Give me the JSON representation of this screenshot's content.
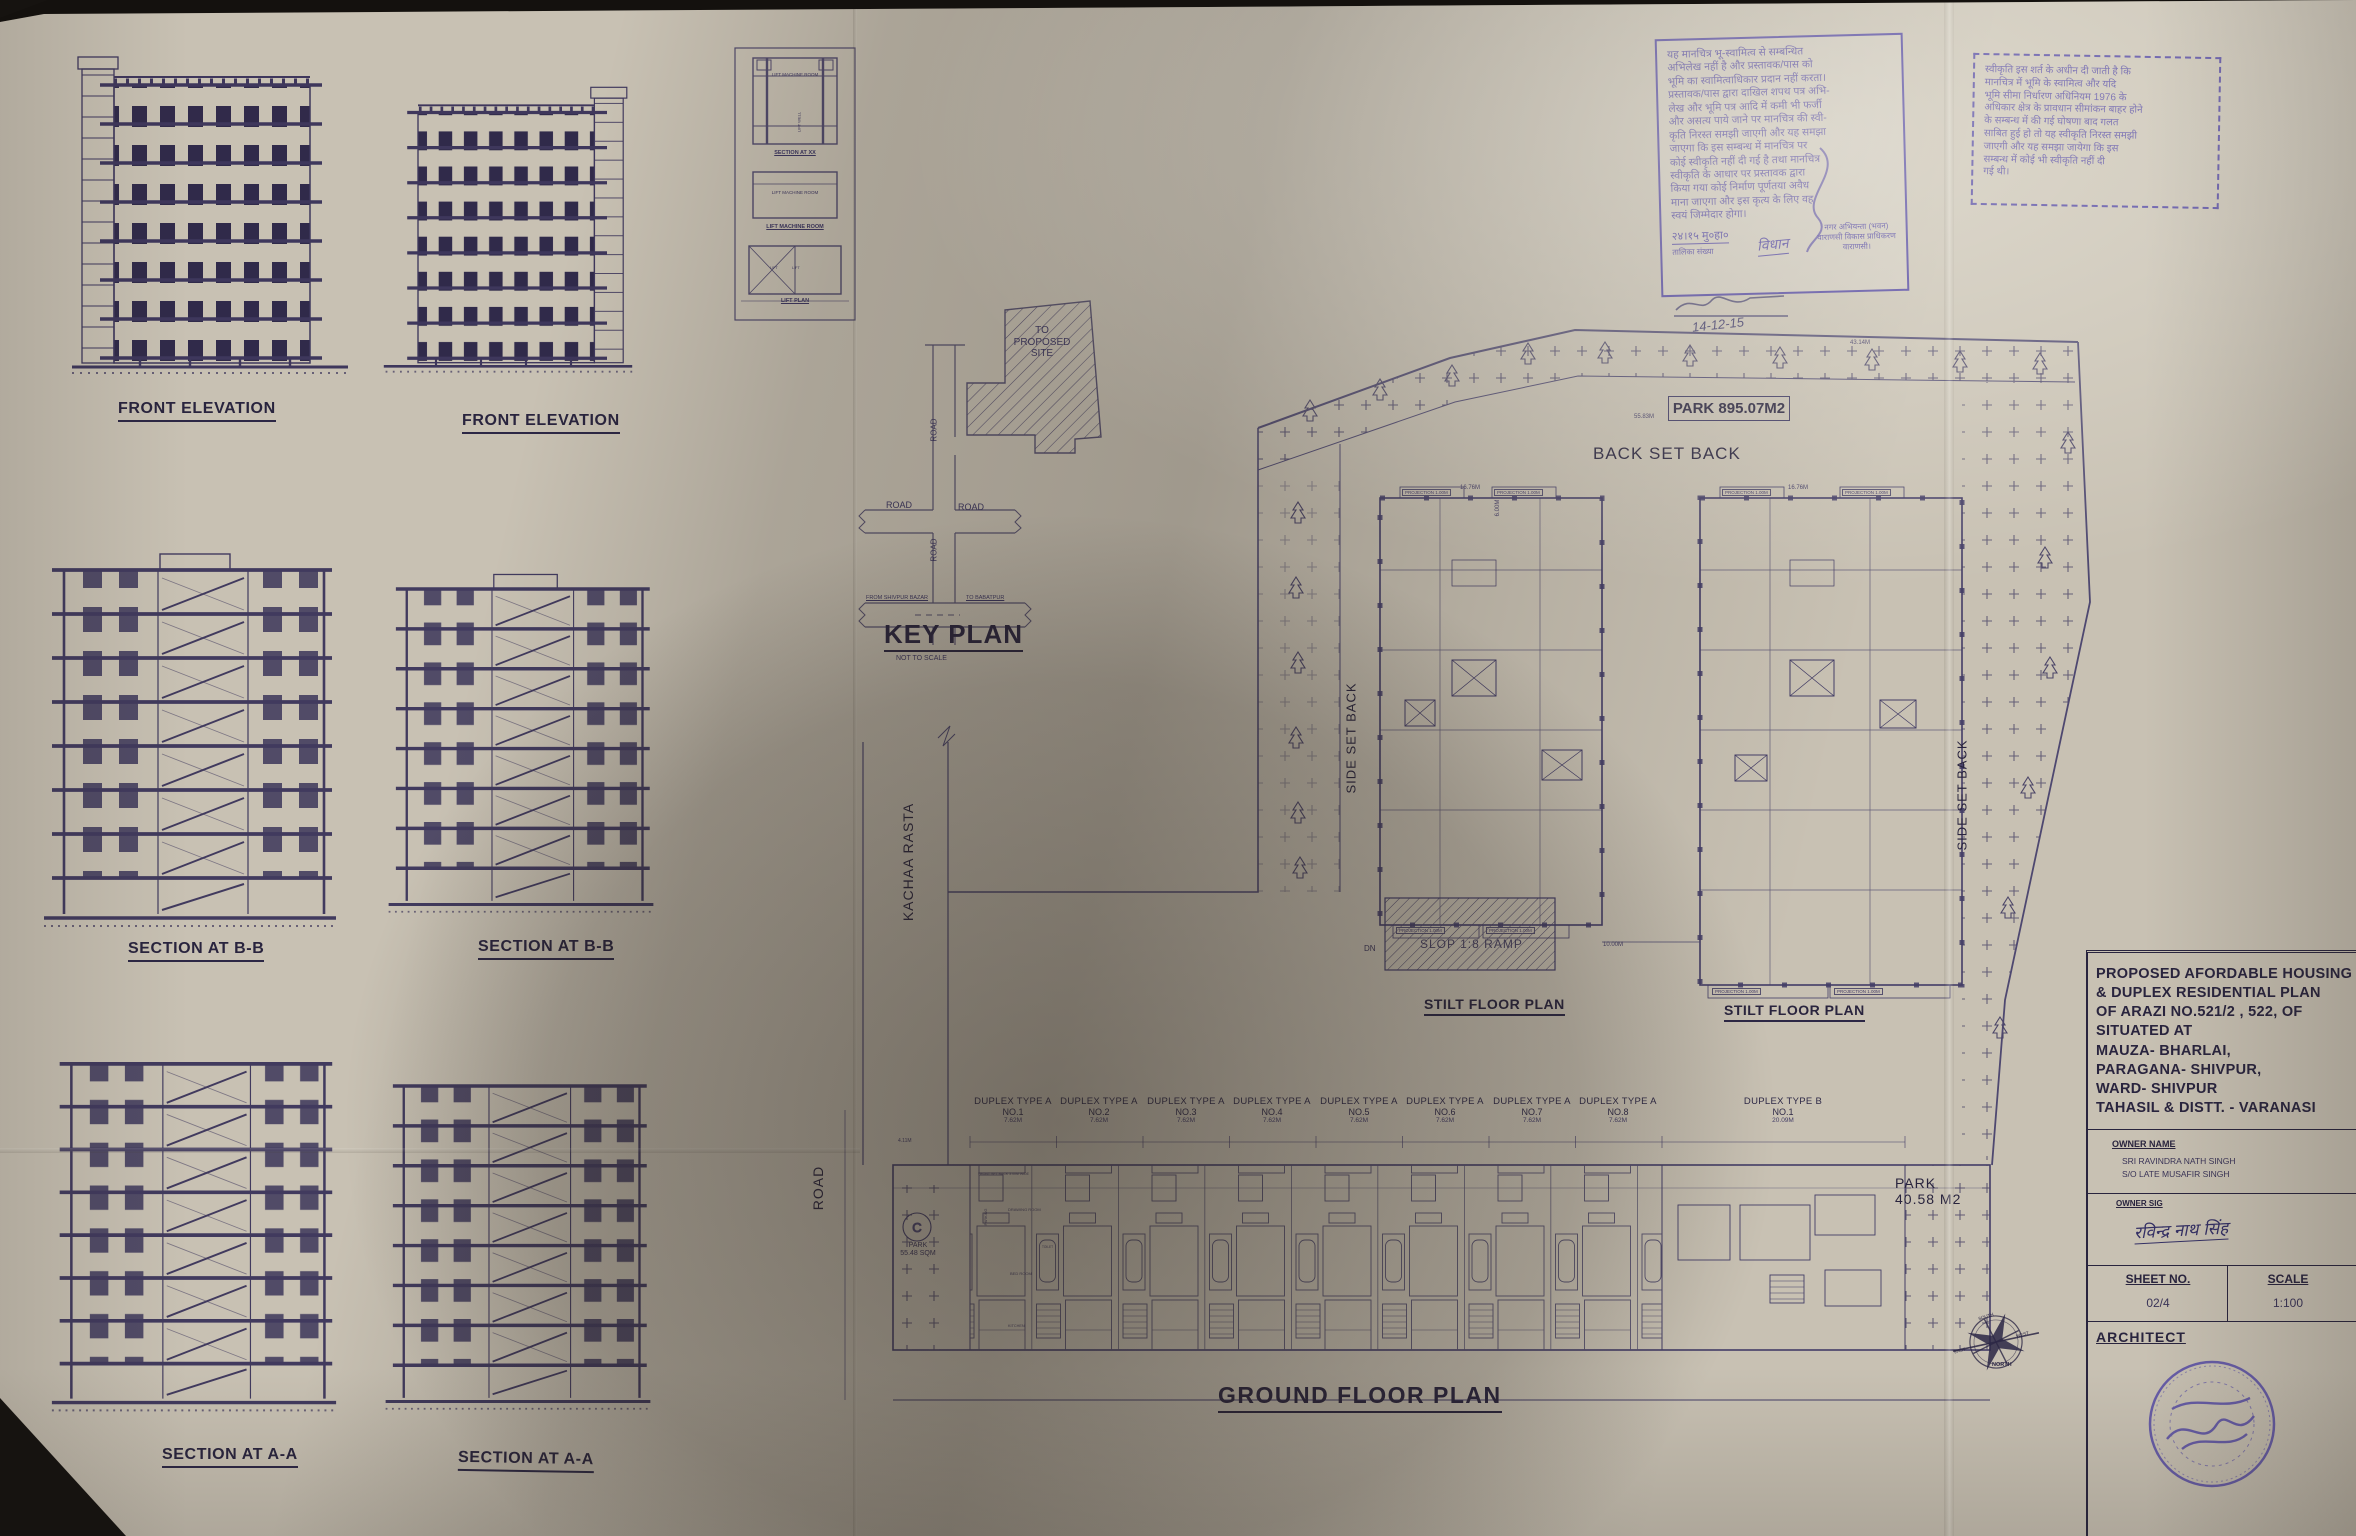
{
  "elevations": {
    "label": "FRONT ELEVATION"
  },
  "sections": {
    "bb": "SECTION AT B-B",
    "aa": "SECTION AT A-A"
  },
  "lift": {
    "machine_room": "LIFT MACHINE ROOM",
    "lift_well": "LIFT WELL",
    "section_caption": "SECTION AT XX",
    "machine_room_caption": "LIFT MACHINE ROOM",
    "plan_caption": "LIFT PLAN",
    "lift": "LIFT"
  },
  "key_plan": {
    "title": "KEY PLAN",
    "subtitle": "NOT TO SCALE",
    "site": "TO PROPOSED SITE",
    "road": "ROAD",
    "from": "FROM SHIVPUR BAZAR",
    "to": "TO BABATPUR"
  },
  "site": {
    "park_top": "PARK 895.07M2",
    "back_set_back": "BACK SET BACK",
    "side_set_back": "SIDE SET BACK",
    "stilt_caption": "STILT FLOOR PLAN",
    "ramp": "SLOP 1:8 RAMP",
    "dn": "DN",
    "projection": "PROJECTION 1.00M",
    "front_setback": "FRONT SET BACK 3.00M WIDE",
    "kachaa_rasta": "KACHAA RASTA",
    "road": "ROAD",
    "c_label": "C",
    "park_left": "PARK\n55.48 SQM",
    "park_right": "PARK\n40.58 M2",
    "ground_title": "GROUND FLOOR PLAN",
    "dims": {
      "top": "43.14M",
      "park_edge": "55.83M",
      "block_top": "16.76M",
      "gap": "10.00M",
      "side": "6.00M",
      "park_small_top": "4.11M"
    },
    "rooms": {
      "parking": "PARKING",
      "drawing": "DRAWING ROOM",
      "kitchen": "KITCHEN",
      "bed": "BED ROOM",
      "toilet": "TOILET"
    },
    "units": [
      {
        "type": "DUPLEX TYPE A",
        "no": "NO.1",
        "dim": "7.62M"
      },
      {
        "type": "DUPLEX TYPE A",
        "no": "NO.2",
        "dim": "7.62M"
      },
      {
        "type": "DUPLEX TYPE A",
        "no": "NO.3",
        "dim": "7.62M"
      },
      {
        "type": "DUPLEX TYPE A",
        "no": "NO.4",
        "dim": "7.62M"
      },
      {
        "type": "DUPLEX TYPE A",
        "no": "NO.5",
        "dim": "7.62M"
      },
      {
        "type": "DUPLEX TYPE A",
        "no": "NO.6",
        "dim": "7.62M"
      },
      {
        "type": "DUPLEX TYPE A",
        "no": "NO.7",
        "dim": "7.62M"
      },
      {
        "type": "DUPLEX TYPE A",
        "no": "NO.8",
        "dim": "7.62M"
      },
      {
        "type": "DUPLEX TYPE B",
        "no": "NO.1",
        "dim": "20.09M"
      }
    ]
  },
  "stamps": {
    "stamp1": {
      "body": "यह मानचित्र भू-स्वामित्व से सम्बन्धित\nअभिलेख नहीं है और प्रस्तावक/पास को\nभूमि का स्वामित्वाधिकार प्रदान नहीं करता।\nप्रस्तावक/पास द्वारा दाखिल शपथ पत्र अभि-\nलेख और भूमि पत्र आदि में कमी भी फर्जी\nऔर असत्य पाये जाने पर मानचित्र की स्वी-\nकृति निरस्त समझी जाएगी और यह समझा\nजाएगा कि इस सम्बन्ध में मानचित्र पर\nकोई स्वीकृति नहीं दी गई है तथा मानचित्र\nस्वीकृति के आधार पर प्रस्तावक द्वारा\nकिया गया कोई निर्माण पूर्णतया अवैध\nमाना जाएगा और इस कृत्य के लिए वह\nस्वयं जिम्मेदार होगा।",
      "date": "२४।१५ मु०हा०",
      "table_no": "तालिका संख्या",
      "sig": "विधान",
      "officer": "नगर अभियन्ता (भवन)\nवाराणसी विकास प्राधिकरण\nवाराणसी।"
    },
    "stamp2": {
      "body": "स्वीकृति इस शर्त के अधीन दी जाती है कि\nमानचित्र में भूमि के स्वामित्व और यदि\nभूमि सीमा निर्धारण अधिनियम 1976 के\nअधिकार क्षेत्र के प्रावधान सीमांकन बाहर होने\nके सम्बन्ध में की गई घोषणा बाद गलत\nसाबित हुई हो तो यह स्वीकृति निरस्त समझी\nजाएगी और यह समझा जायेगा कि इस\nसम्बन्ध में कोई भी स्वीकृति नहीं दी\nगई थी।"
    },
    "handwritten_date": "14-12-15"
  },
  "title_block": {
    "project": "PROPOSED AFORDABLE HOUSING\n& DUPLEX RESIDENTIAL PLAN\nOF ARAZI NO.521/2 , 522, OF\nSITUATED AT\nMAUZA- BHARLAI,\nPARAGANA- SHIVPUR,\nWARD- SHIVPUR\nTAHASIL & DISTT. - VARANASI",
    "owner_name_label": "OWNER NAME",
    "owner_name": "SRI RAVINDRA NATH SINGH\nS/O LATE MUSAFIR SINGH",
    "owner_sig_label": "OWNER SIG",
    "owner_sig": "रविन्द्र नाथ सिंह",
    "sheet_no_label": "SHEET NO.",
    "sheet_no": "02/4",
    "scale_label": "SCALE",
    "scale": "1:100",
    "architect_label": "ARCHITECT"
  },
  "compass": {
    "north": "NORTH",
    "south": "SOUTH",
    "east": "EAST",
    "west": "WEST"
  }
}
